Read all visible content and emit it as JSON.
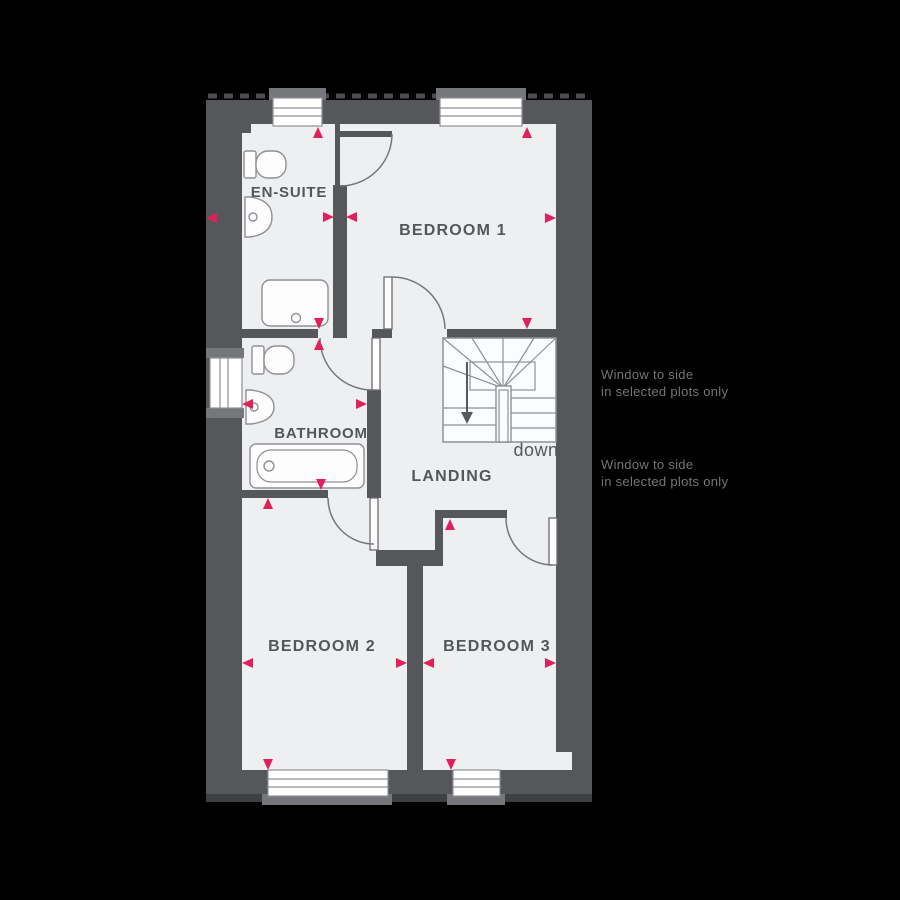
{
  "plan": {
    "type": "floor-plan",
    "rooms": {
      "ensuite": {
        "label": "EN-SUITE"
      },
      "bedroom1": {
        "label": "BEDROOM 1"
      },
      "bathroom": {
        "label": "BATHROOM"
      },
      "landing": {
        "label": "LANDING"
      },
      "bedroom2": {
        "label": "BEDROOM 2"
      },
      "bedroom3": {
        "label": "BEDROOM 3"
      }
    },
    "stairs": {
      "direction_label": "down"
    },
    "fixtures": {
      "ensuite": [
        "toilet",
        "basin",
        "shower"
      ],
      "bathroom": [
        "toilet",
        "basin",
        "bath"
      ]
    },
    "annotations": {
      "note1": {
        "line1": "Window to side",
        "line2": "in selected plots only"
      },
      "note2": {
        "line1": "Window to side",
        "line2": "in selected plots only"
      }
    },
    "colors": {
      "background": "#000000",
      "wall": "#56575b",
      "floor": "#edeff0",
      "fixture_outline": "#8e9094",
      "marker_accent": "#e1205a",
      "label_text": "#55565a",
      "annotation_text": "#737477",
      "window_frame": "#76777a"
    },
    "marker_count": 20
  }
}
